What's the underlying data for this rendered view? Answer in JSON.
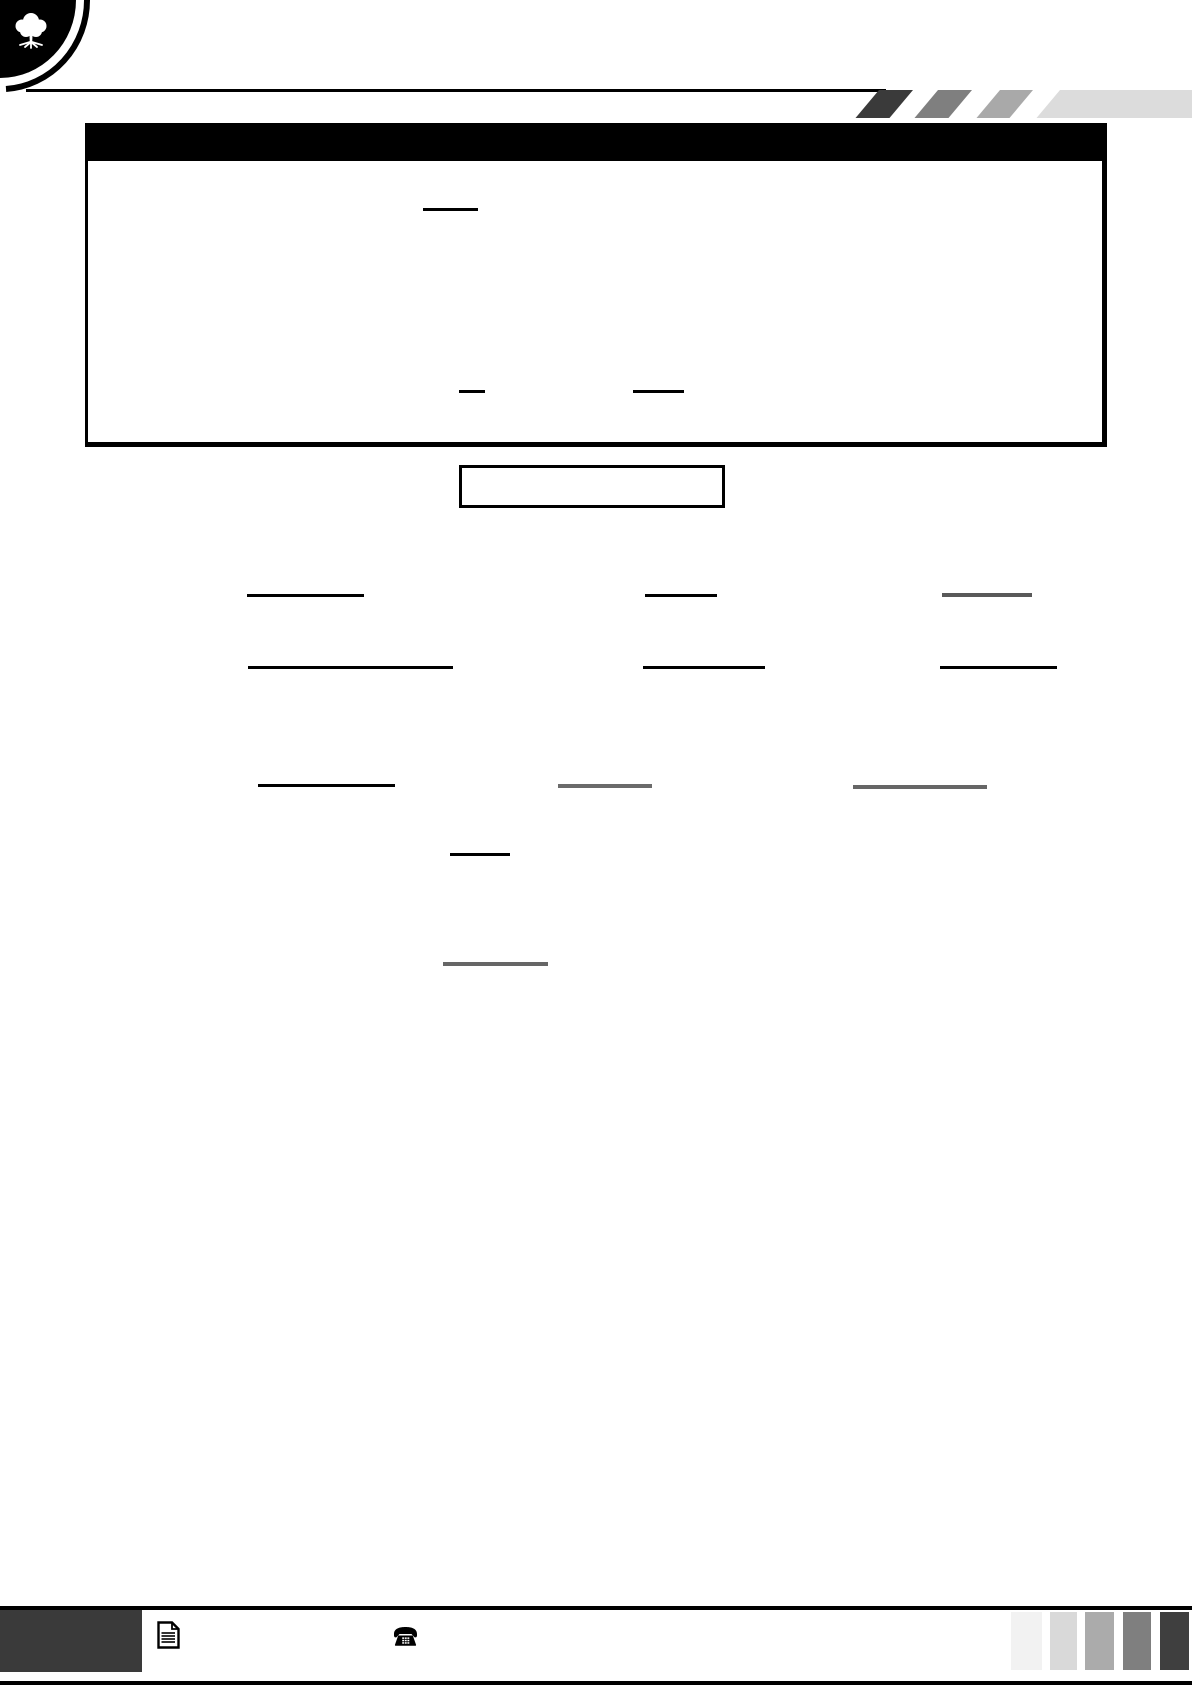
{
  "page": {
    "width": 1192,
    "height": 1685,
    "background": "#ffffff"
  },
  "colors": {
    "ink": "#000000",
    "page_white": "#ffffff",
    "footer_box": "#3a3a3a"
  },
  "logo": {
    "icon": "tree-icon",
    "disc_color": "#000000",
    "tree_color": "#ffffff"
  },
  "header": {
    "parallelograms": {
      "top": 90,
      "height": 28,
      "skew_deg": -40,
      "items": [
        {
          "left": 879,
          "width": 34,
          "color": "#3a3a3a"
        },
        {
          "left": 938,
          "width": 34,
          "color": "#7f7f7f"
        },
        {
          "left": 1000,
          "width": 33,
          "color": "#a9a9a9"
        },
        {
          "left": 1060,
          "width": 170,
          "color": "#dcdcdc"
        }
      ]
    },
    "title_bar": {
      "background": "#000000"
    }
  },
  "main_box": {
    "border_color": "#000000",
    "blanks": [
      {
        "x": 423,
        "y": 208,
        "w": 55,
        "h": 3,
        "color": "#000000"
      },
      {
        "x": 459,
        "y": 390,
        "w": 26,
        "h": 2.5,
        "color": "#000000"
      },
      {
        "x": 633,
        "y": 390,
        "w": 51,
        "h": 2.5,
        "color": "#000000"
      }
    ]
  },
  "inner_box": {
    "border_color": "#000000"
  },
  "body_blanks": [
    {
      "x": 247,
      "y": 594,
      "w": 117,
      "h": 3,
      "color": "#000000"
    },
    {
      "x": 645,
      "y": 594,
      "w": 72,
      "h": 3,
      "color": "#000000"
    },
    {
      "x": 942,
      "y": 593,
      "w": 90,
      "h": 4,
      "color": "#595959"
    },
    {
      "x": 248,
      "y": 666,
      "w": 205,
      "h": 3,
      "color": "#000000"
    },
    {
      "x": 643,
      "y": 666,
      "w": 122,
      "h": 3,
      "color": "#000000"
    },
    {
      "x": 940,
      "y": 666,
      "w": 117,
      "h": 3,
      "color": "#000000"
    },
    {
      "x": 258,
      "y": 784,
      "w": 137,
      "h": 3,
      "color": "#000000"
    },
    {
      "x": 558,
      "y": 784,
      "w": 94,
      "h": 3.5,
      "color": "#6b6b6b"
    },
    {
      "x": 853,
      "y": 785,
      "w": 134,
      "h": 3.5,
      "color": "#666666"
    },
    {
      "x": 450,
      "y": 853,
      "w": 60,
      "h": 3,
      "color": "#000000"
    },
    {
      "x": 443,
      "y": 962,
      "w": 105,
      "h": 4,
      "color": "#666666"
    }
  ],
  "footer": {
    "top_rule_color": "#000000",
    "bottom_rule_color": "#000000",
    "label_box_color": "#3a3a3a",
    "icons": [
      "document-icon",
      "phone-icon"
    ],
    "accent_bars": {
      "y": 1612,
      "height": 58,
      "items": [
        {
          "x": 1011,
          "w": 31,
          "color": "#f2f2f2"
        },
        {
          "x": 1050,
          "w": 27,
          "color": "#d9d9d9"
        },
        {
          "x": 1085,
          "w": 29,
          "color": "#ababab"
        },
        {
          "x": 1123,
          "w": 28,
          "color": "#7f7f7f"
        },
        {
          "x": 1160,
          "w": 29,
          "color": "#3f3f3f"
        }
      ]
    }
  }
}
